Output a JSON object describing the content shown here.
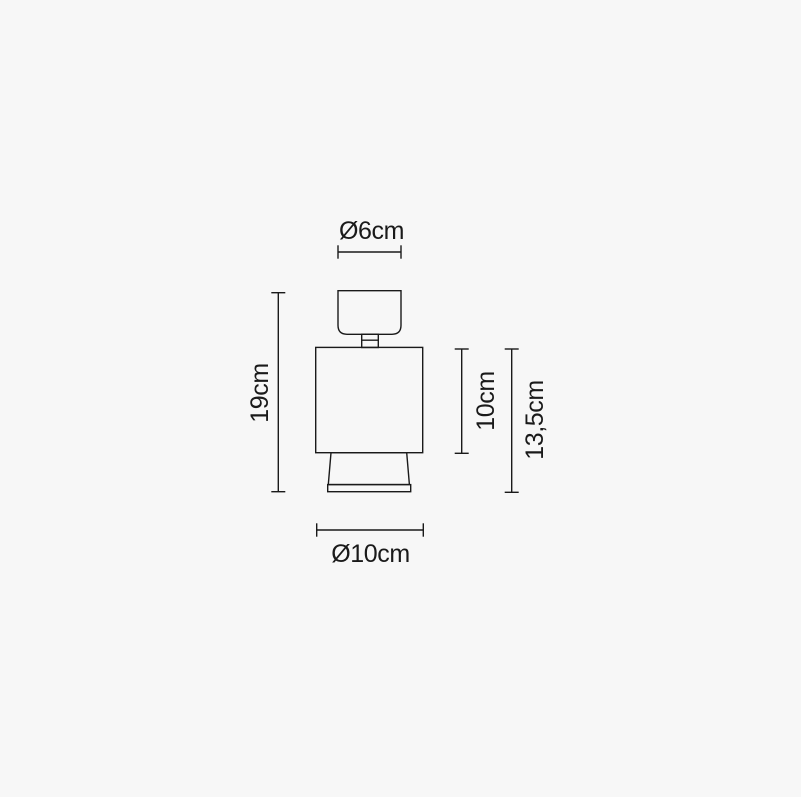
{
  "page": {
    "background_color": "#f7f7f7",
    "line_color": "#1a1a1a",
    "text_color": "#1a1a1a"
  },
  "drawing": {
    "type": "technical-dimension-diagram",
    "subject": "lamp front elevation with dimension lines",
    "labels": {
      "top_diameter": "Ø6cm",
      "total_height": "19cm",
      "body_height": "10cm",
      "body_plus_base_height": "13,5cm",
      "bottom_diameter": "Ø10cm"
    }
  }
}
